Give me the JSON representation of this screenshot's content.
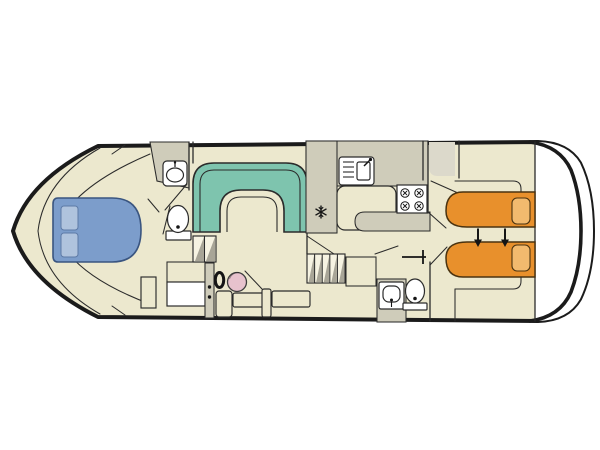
{
  "meta": {
    "type": "boat-deck-plan",
    "orientation": "bow-left-stern-right"
  },
  "colors": {
    "floor": "#ece8ce",
    "wall-gray": "#cfccba",
    "wardrobe-gray": "#dcd9cb",
    "outline": "#1b1b1b",
    "line": "#2b2b2b",
    "sofa-green": "#7ec4ae",
    "bed-blue": "#7c9dcb",
    "pillow-blue": "#afc3dd",
    "bed-orange": "#e8902c",
    "pillow-orange": "#f2ba6e",
    "seat-pink": "#e7c2cd",
    "hatch-gray": "#a8a597",
    "fixture-white": "#ffffff",
    "step-light": "#f6f3e2"
  },
  "icons": {
    "double-bed": "island double bed with two pillows",
    "single-beds": "twin single berths with slide-together arrows",
    "dinette-sofa": "U-shaped bench sofa",
    "galley-sink": "sink with drainer and tap",
    "stove": "four-burner hob",
    "snowflake": "refrigerator",
    "washbasin": "washbasin",
    "toilet": "toilet",
    "shower": "shower tray grid",
    "stairs": "companionway steps",
    "steering-wheel": "inside helm wheel",
    "helm-seat": "helm seat"
  }
}
